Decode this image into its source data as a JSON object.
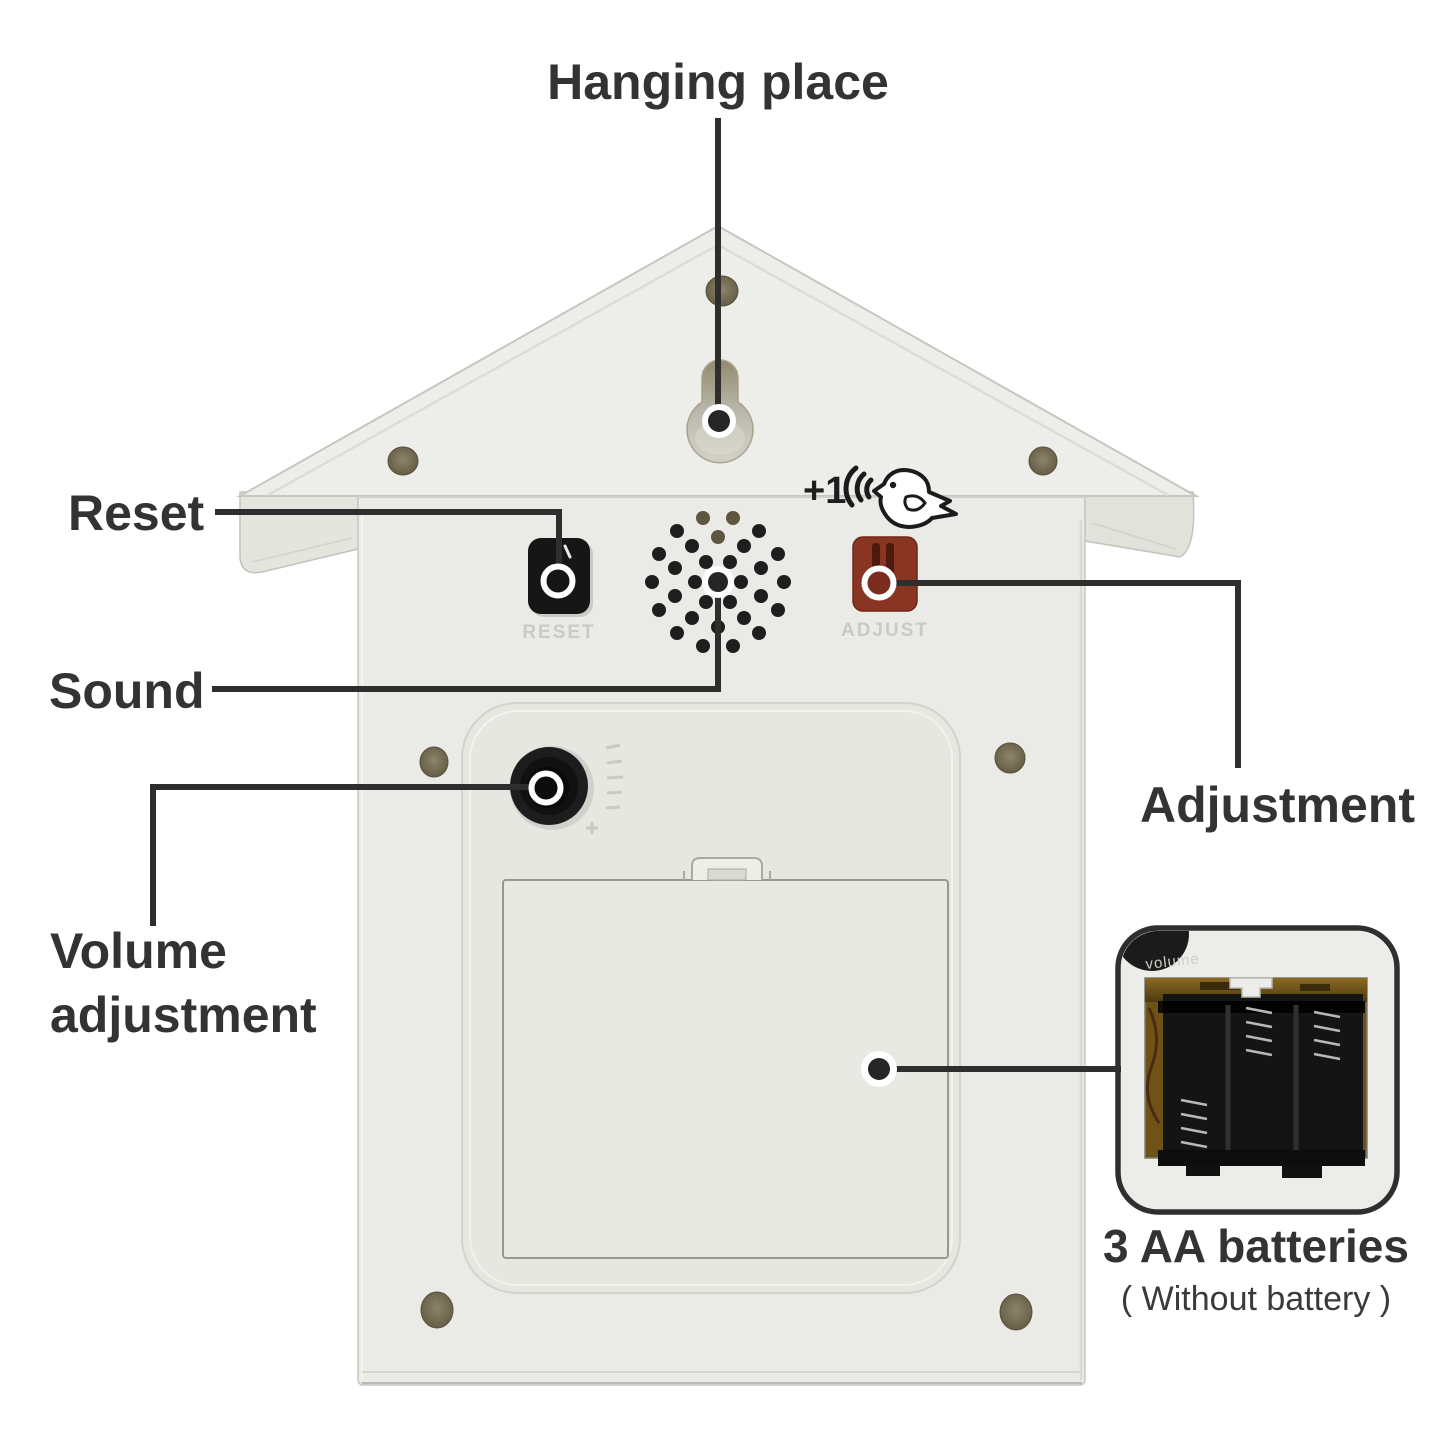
{
  "callout_labels": {
    "hanging_place": "Hanging place",
    "reset": "Reset",
    "sound": "Sound",
    "volume_line1": "Volume",
    "volume_line2": "adjustment",
    "adjustment": "Adjustment",
    "batteries_title": "3 AA batteries",
    "batteries_subtitle": "( Without battery )"
  },
  "device_markings": {
    "reset_button": "RESET",
    "adjust_button": "ADJUST",
    "volume_knob": "Volume",
    "chime_icon_text": "+1",
    "inset_volume": "volume"
  },
  "colors": {
    "callout_line": "#2e2e2e",
    "label_text": "#333333",
    "body_plastic": "#eaebe6",
    "roof_plastic": "#edeee9",
    "recess_plastic": "#e6e7e1",
    "door_plastic": "#e8e9e3",
    "reset_button_black": "#161616",
    "adjust_button_red": "#8a3424",
    "volume_knob_black": "#1d1d1d",
    "embossed_text": "#c9cac2",
    "screw_hole_brown": "#6e6549",
    "inset_border": "#2f2f2f",
    "pcb_brown": "#6f5316",
    "battery_holder_black": "#141414"
  }
}
